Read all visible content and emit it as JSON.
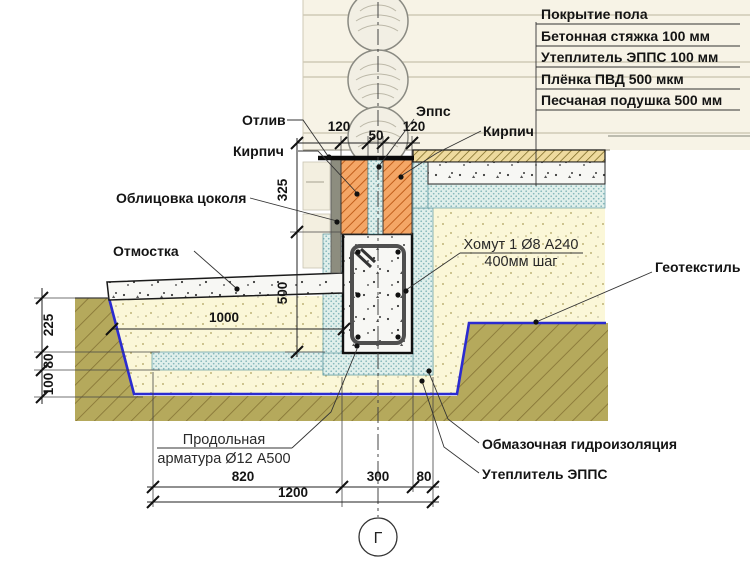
{
  "legend": {
    "items": [
      "Покрытие пола",
      "Бетонная стяжка 100 мм",
      "Утеплитель ЭППС 100 мм",
      "Плёнка ПВД 500 мкм",
      "Песчаная подушка 500 мм"
    ]
  },
  "callouts": {
    "otliv": "Отлив",
    "kirpich_left": "Кирпич",
    "oblicovka": "Облицовка цоколя",
    "otmostka": "Отмостка",
    "epps": "Эппс",
    "kirpich_right": "Кирпич",
    "homut_line1": "Хомут 1 Ø8 А240",
    "homut_line2": "400мм шаг",
    "geotekstil": "Геотекстиль",
    "prodolnaya_line1": "Продольная",
    "prodolnaya_line2": "арматура Ø12 А500",
    "obmazochnaya": "Обмазочная гидроизоляция",
    "uteplitel_epps": "Утеплитель ЭППС"
  },
  "dimensions": {
    "wall_left_brick": "120",
    "wall_insulation": "50",
    "wall_right_brick": "120",
    "plinth_height": "325",
    "beam_height": "500",
    "depth_225": "225",
    "depth_80": "80",
    "depth_100": "100",
    "blind_area_sand": "1000",
    "bottom_820": "820",
    "bottom_300": "300",
    "bottom_80": "80",
    "bottom_total": "1200"
  },
  "axis_marker": {
    "label": "Г"
  },
  "colors": {
    "brick": "#f4a666",
    "brick_hatch": "#c2601d",
    "soil": "#b5a95c",
    "sand": "#fbf7d8",
    "xps": "#e0efeb",
    "geotextile": "#2b2bd0",
    "concrete": "#f7f7f4",
    "siding": "#f7f3e6",
    "finish_layer": "#eeda9e"
  }
}
